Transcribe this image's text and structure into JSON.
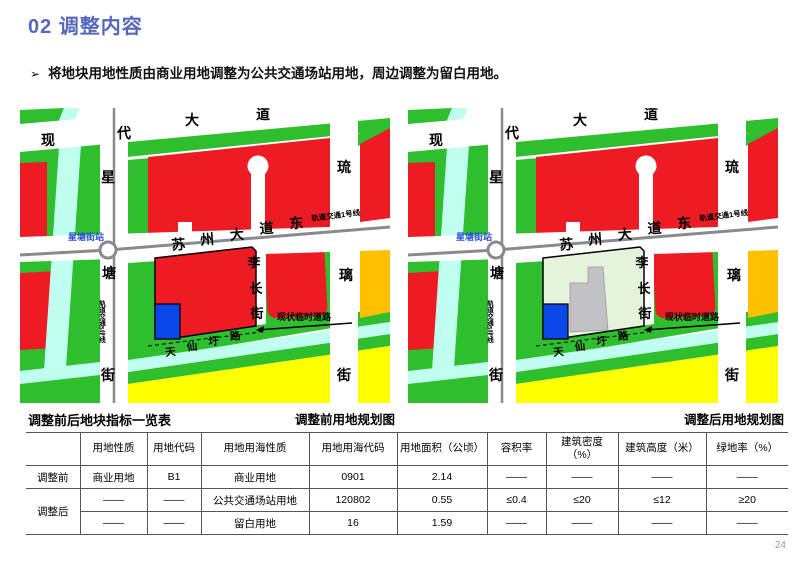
{
  "header": {
    "title": "02 调整内容"
  },
  "bullet": {
    "marker": "➢",
    "text": "将地块用地性质由商业用地调整为公共交通场站用地，周边调整为留白用地。"
  },
  "maps": {
    "labels": {
      "modern_ave": [
        "现",
        "代",
        "大",
        "道"
      ],
      "xingtang_st": [
        "星",
        "塘",
        "街"
      ],
      "metro5": "轨道交通5号线",
      "station": "星塘街站",
      "suzhou_ave": [
        "苏",
        "州",
        "大",
        "道",
        "东"
      ],
      "metro1": "轨道交通1号线",
      "liuli_st": [
        "琉",
        "璃",
        "街"
      ],
      "lichang_st": [
        "李",
        "长",
        "街"
      ],
      "temp_road": "现状临时道路",
      "tianxianwei_rd": [
        "天",
        "仙",
        "圩",
        "路"
      ]
    },
    "captions": {
      "before": "调整前用地规划图",
      "after": "调整后用地规划图"
    }
  },
  "table": {
    "title": "调整前后地块指标一览表",
    "headers": [
      "",
      "用地性质",
      "用地代码",
      "用地用海性质",
      "用地用海代码",
      "用地面积（公顷）",
      "容积率",
      "建筑密度（%）",
      "建筑高度（米）",
      "绿地率（%）"
    ],
    "rows": [
      {
        "label": "调整前",
        "cells": [
          "商业用地",
          "B1",
          "商业用地",
          "0901",
          "2.14",
          "——",
          "——",
          "——",
          "——"
        ]
      },
      {
        "label": "调整后",
        "cells": [
          "——",
          "——",
          "公共交通场站用地",
          "120802",
          "0.55",
          "≤0.4",
          "≤20",
          "≤12",
          "≥20"
        ]
      },
      {
        "label": "",
        "cells": [
          "——",
          "——",
          "留白用地",
          "16",
          "1.59",
          "——",
          "——",
          "——",
          "——"
        ]
      }
    ]
  },
  "page_number": "24",
  "colors": {
    "title": "#5568bd",
    "commercial_red": "#ed1c24",
    "green_space": "#2fbe2e",
    "canal_cyan": "#c0fff0",
    "residential_yellow": "#ffff00",
    "orange": "#ffc000",
    "plot_blue": "#0a46e8",
    "reserve_green": "#e4f3da",
    "building_gray": "#c2c2c6",
    "road_gray": "#8a8a8a",
    "station_text_blue": "#2b50d6"
  }
}
